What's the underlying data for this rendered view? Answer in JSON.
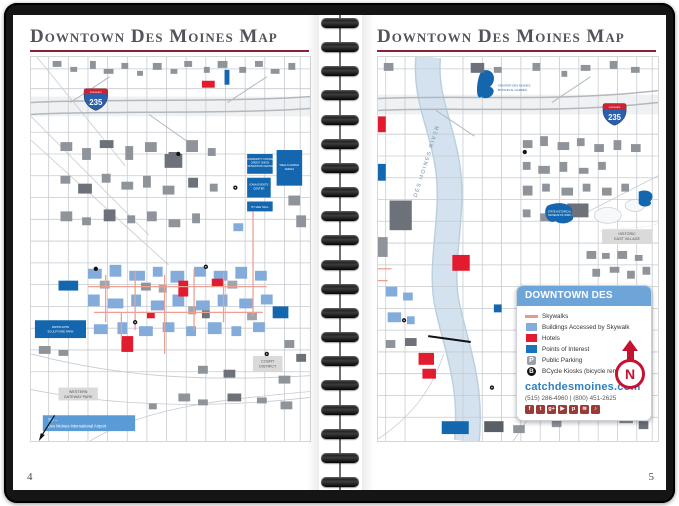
{
  "left_page": {
    "title": "Downtown Des Moines Map",
    "page_number": "4",
    "map": {
      "interstate_band": "INTERSTATE",
      "interstate_number": "235",
      "western_gateway_line1": "WESTERN",
      "western_gateway_line2": "GATEWAY PARK",
      "court_district_line1": "COURT",
      "court_district_line2": "DISTRICT",
      "airport_line1": "TO –",
      "airport_line2": "Des Moines International Airport",
      "convention_center_line1": "COMMUNITY CHOICE",
      "convention_center_line2": "CREDIT UNION",
      "convention_center_line3": "CONVENTION CENTER",
      "arena_line1": "WELLS FARGO",
      "arena_line2": "ARENA",
      "events_center_line1": "IOWA EVENTS",
      "events_center_line2": "CENTER",
      "hyvee_hall": "HY-VEE HALL",
      "sculpture_park_line1": "PAPPAJOHN",
      "sculpture_park_line2": "SCULPTURE PARK"
    }
  },
  "right_page": {
    "title": "Downtown Des Moines Map",
    "page_number": "5",
    "map": {
      "interstate_band": "INTERSTATE",
      "interstate_number": "235",
      "river_label": "DES MOINES RIVER",
      "east_village_line1": "HISTORIC",
      "east_village_line2": "EAST VILLAGE",
      "botanical_line1": "GREATER DES MOINES",
      "botanical_line2": "BOTANICAL GARDEN",
      "museum_line1": "STATE HISTORICAL",
      "museum_line2": "MUSEUM OF IOWA"
    },
    "legend": {
      "title": "DOWNTOWN DES MOINES",
      "items": [
        {
          "label": "Skywalks"
        },
        {
          "label": "Buildings Accessed by Skywalk"
        },
        {
          "label": "Hotels"
        },
        {
          "label": "Points of Interest"
        },
        {
          "label": "Public Parking"
        },
        {
          "label": "BCycle Kiosks (bicycle rental)"
        }
      ],
      "parking_glyph": "P",
      "bcycle_glyph": "B",
      "website": "catchdesmoines.com",
      "phones": "(515) 286-4960  |  (800) 451-2625",
      "north_label": "N",
      "social": [
        {
          "name": "facebook",
          "glyph": "f"
        },
        {
          "name": "twitter",
          "glyph": "t"
        },
        {
          "name": "google-plus",
          "glyph": "g+"
        },
        {
          "name": "youtube",
          "glyph": "▶"
        },
        {
          "name": "pinterest",
          "glyph": "p"
        },
        {
          "name": "rss",
          "glyph": "≋"
        },
        {
          "name": "songbird",
          "glyph": "♪"
        }
      ]
    }
  },
  "colors": {
    "cover": "#151515",
    "title_text": "#53535b",
    "title_rule": "#8c2133",
    "skywalk": "#e8998c",
    "building_skywalk": "#84acdb",
    "hotel": "#e21b2e",
    "poi": "#1a74bc",
    "river": "#d3e2ee",
    "legend_header": "#6ea5d9",
    "website_blue": "#2f7fc1",
    "north_arrow_red": "#c41230"
  }
}
